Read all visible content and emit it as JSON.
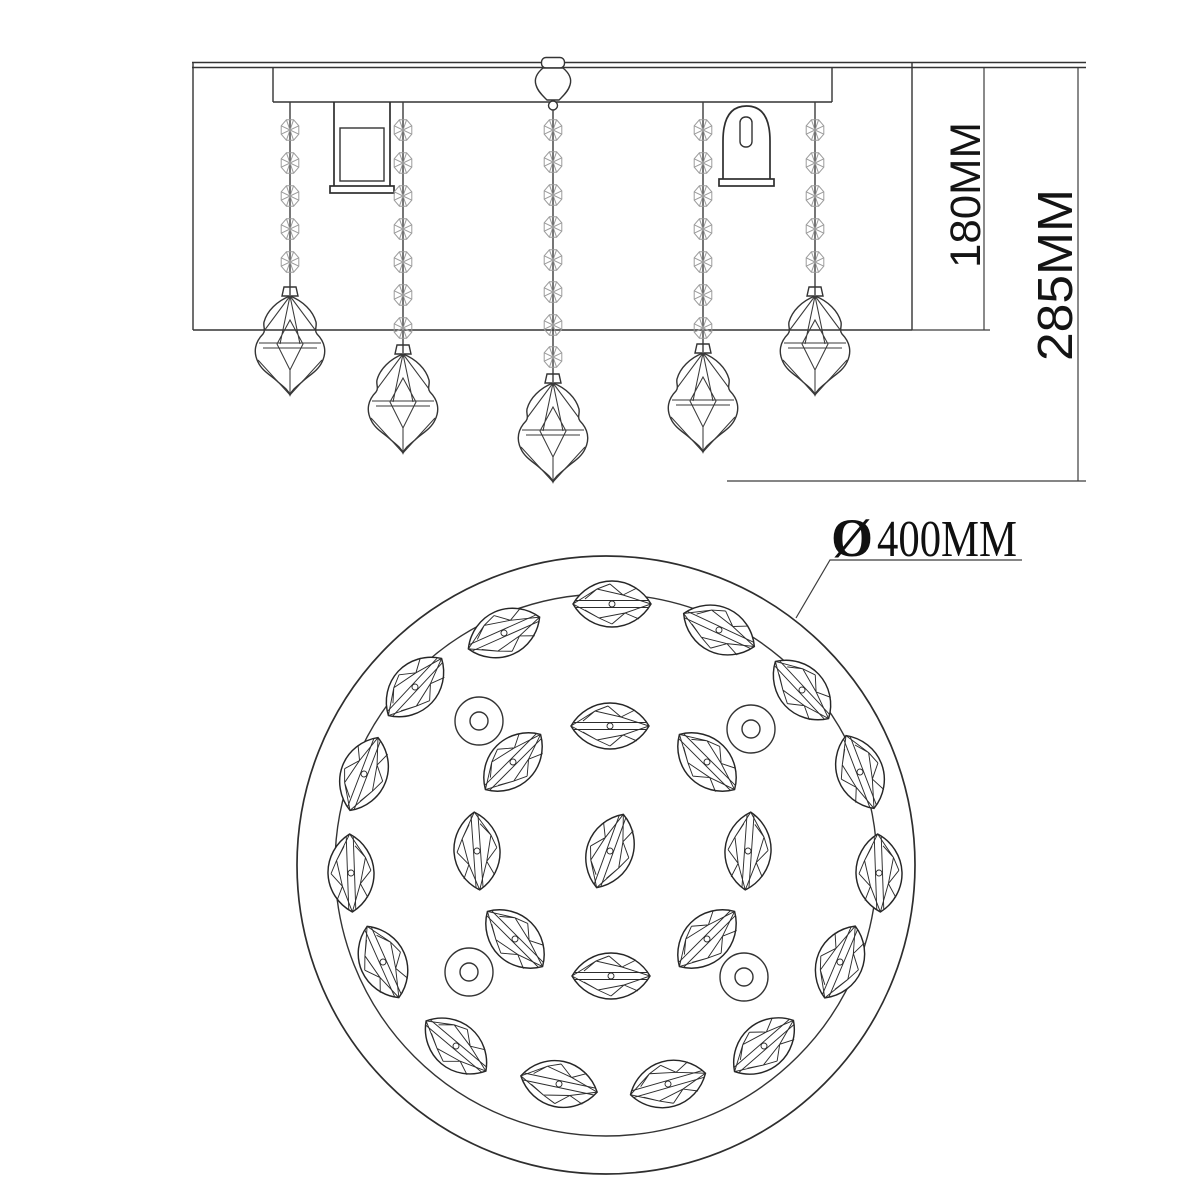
{
  "labels": {
    "body_height": "180MM",
    "total_height": "285MM",
    "diameter_symbol": "Ø",
    "diameter_value": "400MM"
  },
  "colors": {
    "line": "#2e2e2e",
    "bead_line": "#9c9c9c",
    "background": "#ffffff"
  },
  "elevation": {
    "strand_count": 5,
    "strands": [
      {
        "x": 290,
        "start_y": 102,
        "beads": [
          130,
          163,
          196,
          229,
          262
        ],
        "pendant_top": 287
      },
      {
        "x": 403,
        "start_y": 102,
        "beads": [
          130,
          163,
          196,
          229,
          262,
          295,
          328
        ],
        "pendant_top": 345
      },
      {
        "x": 553,
        "start_y": 110,
        "beads": [
          130,
          162,
          195,
          227,
          260,
          292,
          325,
          357
        ],
        "pendant_top": 374
      },
      {
        "x": 703,
        "start_y": 102,
        "beads": [
          130,
          163,
          196,
          229,
          262,
          295,
          328
        ],
        "pendant_top": 344
      },
      {
        "x": 815,
        "start_y": 102,
        "beads": [
          130,
          163,
          196,
          229,
          262
        ],
        "pendant_top": 287
      }
    ]
  },
  "plan": {
    "crystal_count": 24,
    "screw_hole_count": 4,
    "crystals": [
      {
        "x": 612,
        "y": 604,
        "r": 0
      },
      {
        "x": 719,
        "y": 630,
        "r": 25
      },
      {
        "x": 802,
        "y": 690,
        "r": 47
      },
      {
        "x": 860,
        "y": 772,
        "r": 69
      },
      {
        "x": 879,
        "y": 873,
        "r": 88
      },
      {
        "x": 840,
        "y": 962,
        "r": -67
      },
      {
        "x": 764,
        "y": 1046,
        "r": -41
      },
      {
        "x": 668,
        "y": 1084,
        "r": -16
      },
      {
        "x": 559,
        "y": 1084,
        "r": 12
      },
      {
        "x": 456,
        "y": 1046,
        "r": 40
      },
      {
        "x": 383,
        "y": 962,
        "r": 66
      },
      {
        "x": 351,
        "y": 873,
        "r": 88
      },
      {
        "x": 364,
        "y": 774,
        "r": -69
      },
      {
        "x": 415,
        "y": 687,
        "r": -47
      },
      {
        "x": 504,
        "y": 633,
        "r": -24
      },
      {
        "x": 610,
        "y": 726,
        "r": 0
      },
      {
        "x": 513,
        "y": 762,
        "r": -45
      },
      {
        "x": 707,
        "y": 762,
        "r": 45
      },
      {
        "x": 477,
        "y": 851,
        "r": 86
      },
      {
        "x": 610,
        "y": 851,
        "r": -70
      },
      {
        "x": 748,
        "y": 851,
        "r": 94
      },
      {
        "x": 515,
        "y": 939,
        "r": 45
      },
      {
        "x": 707,
        "y": 939,
        "r": -45
      },
      {
        "x": 611,
        "y": 976,
        "r": 0
      }
    ],
    "screw_holes": [
      {
        "x": 479,
        "y": 721
      },
      {
        "x": 751,
        "y": 729
      },
      {
        "x": 469,
        "y": 972
      },
      {
        "x": 744,
        "y": 977
      }
    ]
  }
}
